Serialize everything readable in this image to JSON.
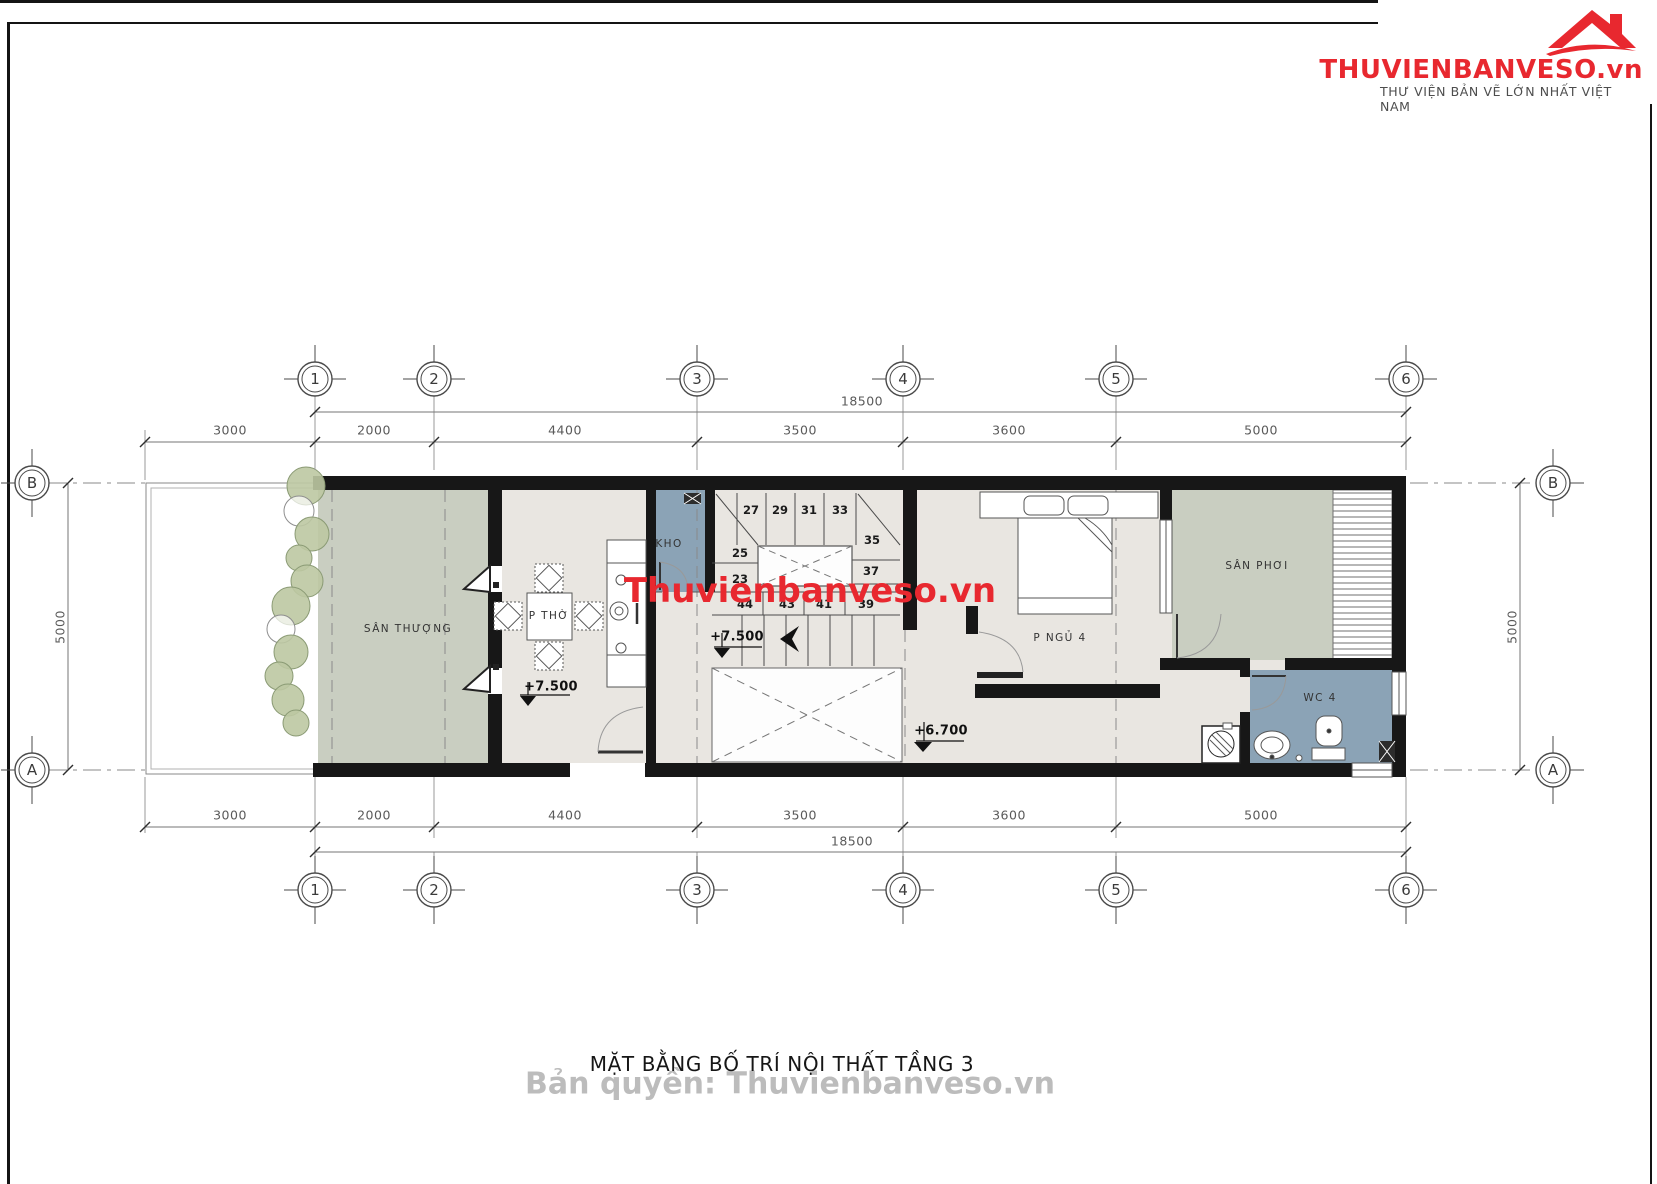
{
  "brand": {
    "name": "THUVIENBANVESO.vn",
    "tagline": "THƯ VIỆN BẢN VẼ LỚN NHẤT VIỆT NAM"
  },
  "title": "MẶT BẰNG BỐ TRÍ NỘI THẤT TẦNG 3",
  "watermarks": {
    "center": "Thuvienbanveso.vn",
    "bottom": "Bản quyền: Thuvienbanveso.vn"
  },
  "axes": {
    "cols": [
      "1",
      "2",
      "3",
      "4",
      "5",
      "6"
    ],
    "rows": [
      "A",
      "B"
    ]
  },
  "dims": {
    "total": "18500",
    "segments": [
      "3000",
      "2000",
      "4400",
      "3500",
      "3600",
      "5000"
    ],
    "side": "5000"
  },
  "rooms": {
    "terrace": "SÂN THƯỢNG",
    "worship": "P THỜ",
    "storage": "KHO",
    "bedroom": "P NGỦ 4",
    "drying": "SÂN PHƠI",
    "wc": "WC 4"
  },
  "levels": {
    "worship": "+7.500",
    "stair": "+7.500",
    "hall": "+6.700"
  },
  "stairs": {
    "numbers": [
      "27",
      "29",
      "31",
      "33",
      "35",
      "25",
      "37",
      "23",
      "44",
      "43",
      "41",
      "39"
    ]
  },
  "colors": {
    "accent_red": "#e8282f",
    "floor": "#e9e6e1",
    "garden": "#c9cec1",
    "wet_room": "#8ba3b6",
    "wall": "#171717"
  }
}
